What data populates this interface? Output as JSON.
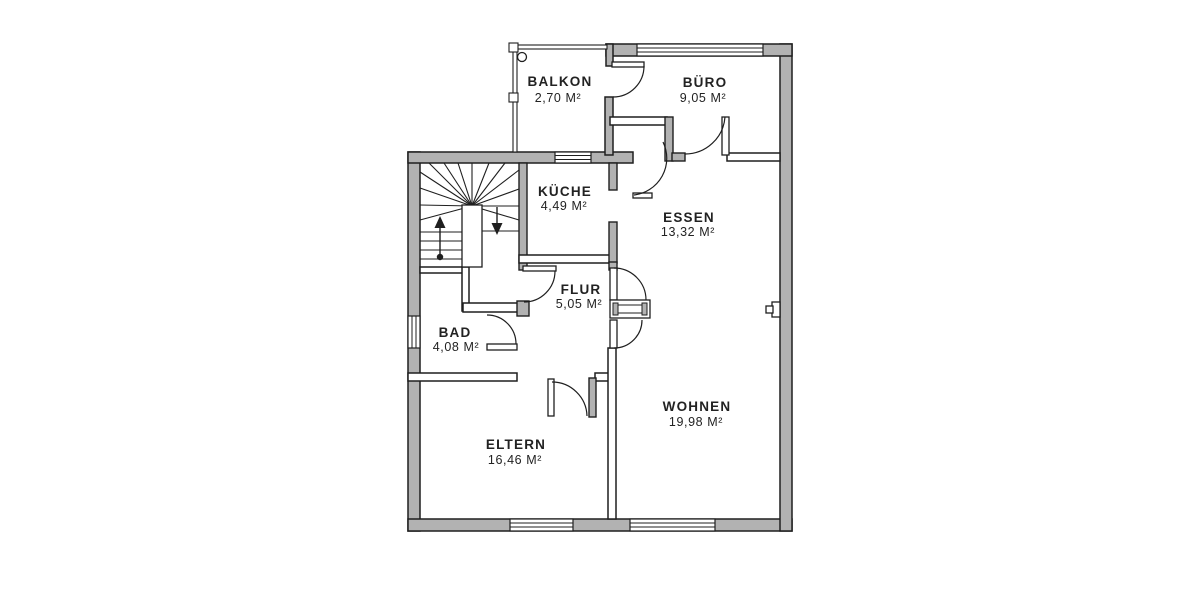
{
  "plan": {
    "type": "floor-plan",
    "rooms": [
      {
        "id": "balkon",
        "name": "BALKON",
        "area": "2,70 M²"
      },
      {
        "id": "buero",
        "name": "BÜRO",
        "area": "9,05 M²"
      },
      {
        "id": "kueche",
        "name": "KÜCHE",
        "area": "4,49 M²"
      },
      {
        "id": "essen",
        "name": "ESSEN",
        "area": "13,32 M²"
      },
      {
        "id": "flur",
        "name": "FLUR",
        "area": "5,05 M²"
      },
      {
        "id": "bad",
        "name": "BAD",
        "area": "4,08 M²"
      },
      {
        "id": "eltern",
        "name": "ELTERN",
        "area": "16,46 M²"
      },
      {
        "id": "wohnen",
        "name": "WOHNEN",
        "area": "19,98 M²"
      }
    ],
    "colors": {
      "wall_fill": "#b2b2b2",
      "outline": "#1f1f1f",
      "text": "#222222",
      "background": "#ffffff"
    }
  }
}
